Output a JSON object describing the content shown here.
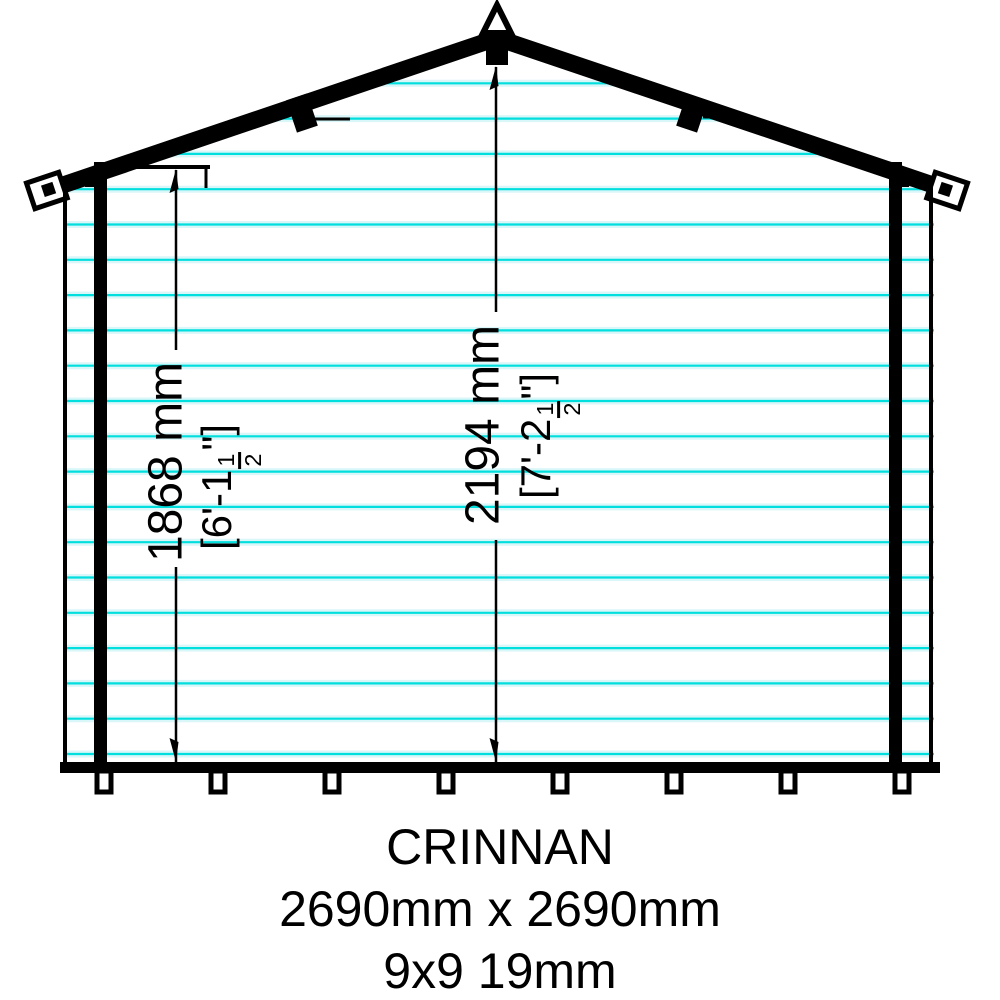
{
  "title_block": {
    "product_name": "CRINNAN",
    "footprint": "2690mm x 2690mm",
    "spec": "9x9 19mm"
  },
  "dimensions": {
    "eaves_height": {
      "metric": "1868 mm",
      "imperial_prefix": "[6'-1",
      "fraction_numerator": "1",
      "fraction_denominator": "2",
      "imperial_suffix": "\"]"
    },
    "ridge_height": {
      "metric": "2194 mm",
      "imperial_prefix": "[7'-2",
      "fraction_numerator": "1",
      "fraction_denominator": "2",
      "imperial_suffix": "\"]"
    }
  },
  "colors": {
    "cladding_core": "#00dedeff",
    "cladding_halo": "#d9f6f8",
    "ink": "#000000",
    "background": "#ffffff"
  },
  "cladding": {
    "first_line_y": 48,
    "line_spacing": 35.3,
    "line_count": 21,
    "x_start": 64,
    "x_end": 934
  }
}
